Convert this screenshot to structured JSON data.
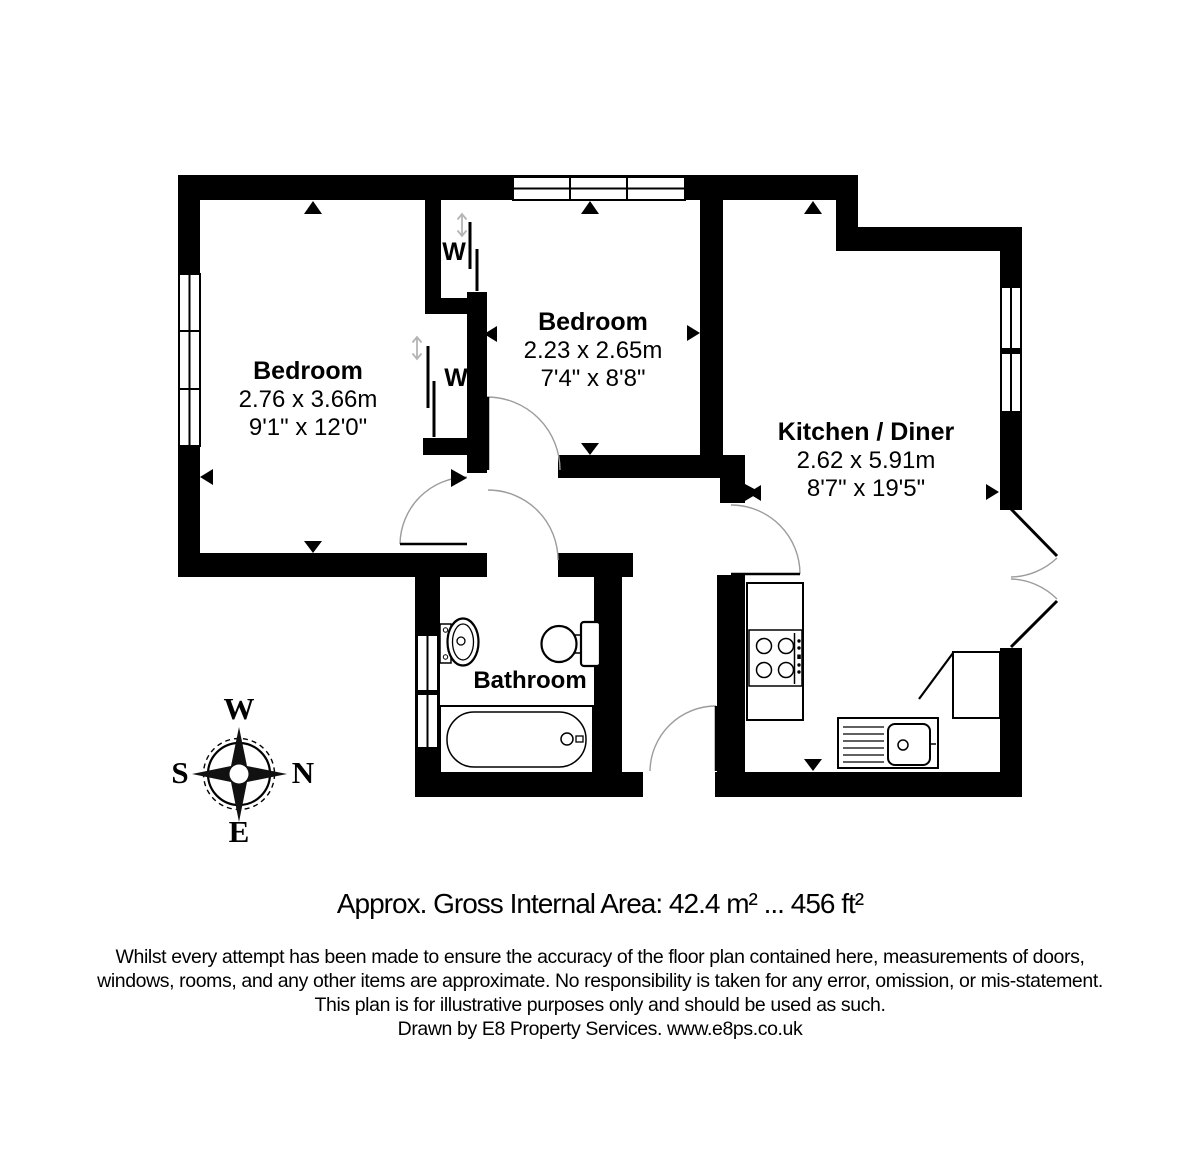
{
  "rooms": {
    "bedroom1": {
      "name": "Bedroom",
      "metric": "2.76 x 3.66m",
      "imperial": "9'1\" x 12'0\""
    },
    "bedroom2": {
      "name": "Bedroom",
      "metric": "2.23 x 2.65m",
      "imperial": "7'4\" x 8'8\""
    },
    "kitchen": {
      "name": "Kitchen / Diner",
      "metric": "2.62 x 5.91m",
      "imperial": "8'7\" x 19'5\""
    },
    "bathroom": {
      "name": "Bathroom"
    }
  },
  "wardrobes": {
    "wardrobe1": "W",
    "wardrobe2": "W"
  },
  "compass": {
    "top": "W",
    "right": "N",
    "left": "S",
    "bottom": "E"
  },
  "footer": {
    "area_line": "Approx. Gross Internal Area: 42.4 m² ... 456 ft²",
    "disclaimer1": "Whilst every attempt has been made to ensure the accuracy of the floor plan contained here, measurements of doors,",
    "disclaimer2": "windows, rooms, and any other items are approximate. No responsibility is taken for any error, omission, or mis-statement.",
    "disclaimer3": "This plan is for illustrative purposes only and should be used as such.",
    "credit": "Drawn by E8 Property Services. www.e8ps.co.uk"
  },
  "colors": {
    "wall": "#000000",
    "door_arc": "#9c9c9c",
    "wardrobe_arrow": "#b4b4b4",
    "background": "#ffffff"
  }
}
